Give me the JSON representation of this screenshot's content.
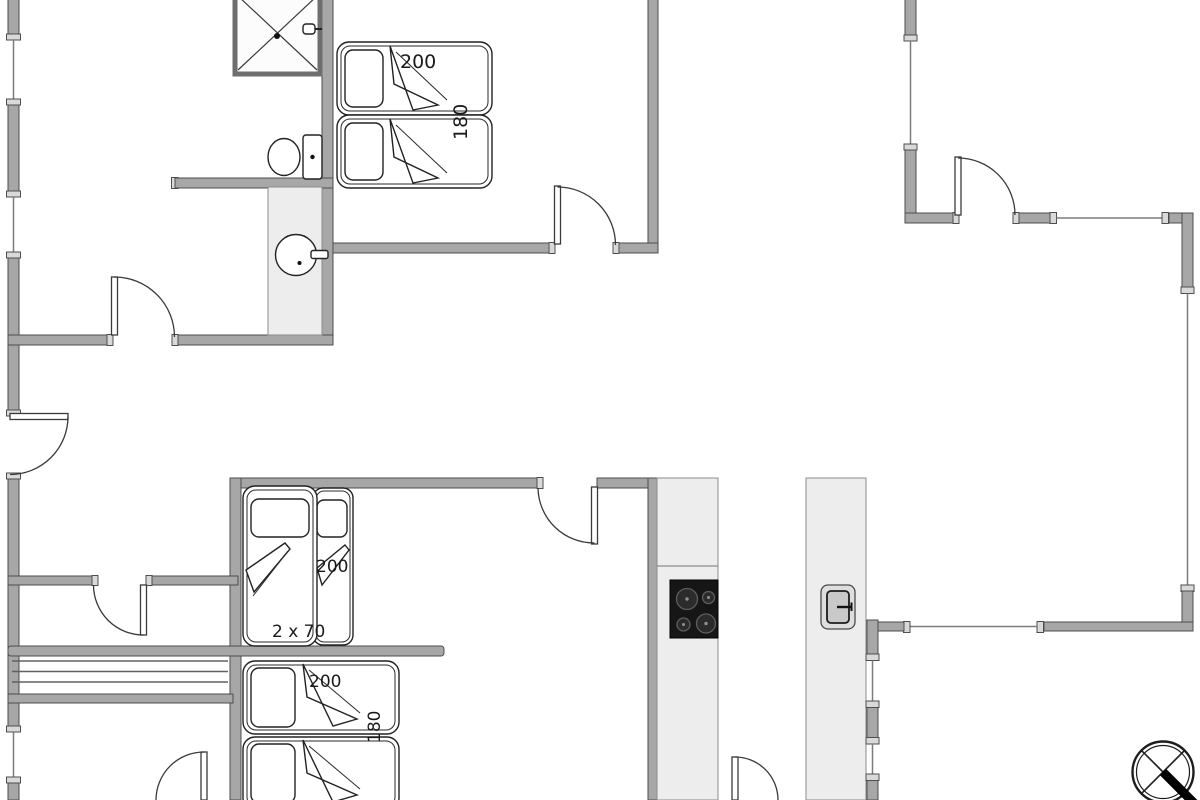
{
  "document": {
    "type": "floor-plan",
    "description": "Holiday home floor plan with three bedrooms, bathroom, open kitchen-living area and north arrow"
  },
  "dimension_labels": {
    "top_bedroom_bed_length": "200",
    "top_bedroom_bed_width": "180",
    "middle_bedroom_bed_length": "200",
    "middle_bedroom_bed_width": "2 x 70",
    "bottom_bedroom_bed_length": "200",
    "bottom_bedroom_bed_width": "180"
  },
  "fixtures": {
    "bathroom": [
      "shower-icon",
      "toilet-icon",
      "washbasin-icon"
    ],
    "kitchen": [
      "cooktop-icon",
      "oven-icon",
      "kitchen-counter",
      "kitchen-island"
    ],
    "circulation": [
      "stairs",
      "interior-doors",
      "entrance-door",
      "windows"
    ],
    "orientation": [
      "north-arrow-compass-icon"
    ]
  },
  "colors": {
    "wall": "#a7a7a7",
    "wall_outline": "#4e4e4e",
    "fixture_area": "#ededed",
    "window_cap": "#d9d9d9",
    "cooktop": "#161616",
    "line": "#222222",
    "background": "#ffffff"
  }
}
